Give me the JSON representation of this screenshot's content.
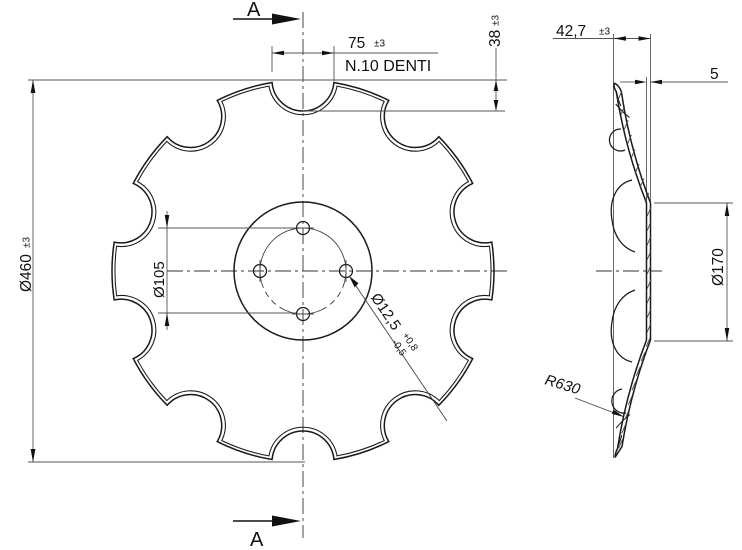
{
  "drawing_type": "technical drawing - notched disc blade",
  "front_view": {
    "outer_diameter": {
      "value": "Ø460",
      "tolerance": "±3"
    },
    "tooth_width": {
      "value": "75",
      "tolerance": "±3"
    },
    "teeth_note": "N.10 DENTI",
    "notch_depth": {
      "value": "38",
      "tolerance": "±3"
    },
    "bolt_circle_diameter": "Ø105",
    "hole": {
      "value": "Ø12,5",
      "tol_plus": "+0,8",
      "tol_minus": "-0,5"
    },
    "section_label": "A",
    "notch_count": 10,
    "bolt_hole_count": 4
  },
  "side_view": {
    "dish_depth": {
      "value": "42,7",
      "tolerance": "±3"
    },
    "thickness": "5",
    "flat_diameter": "Ø170",
    "radius": "R630"
  }
}
